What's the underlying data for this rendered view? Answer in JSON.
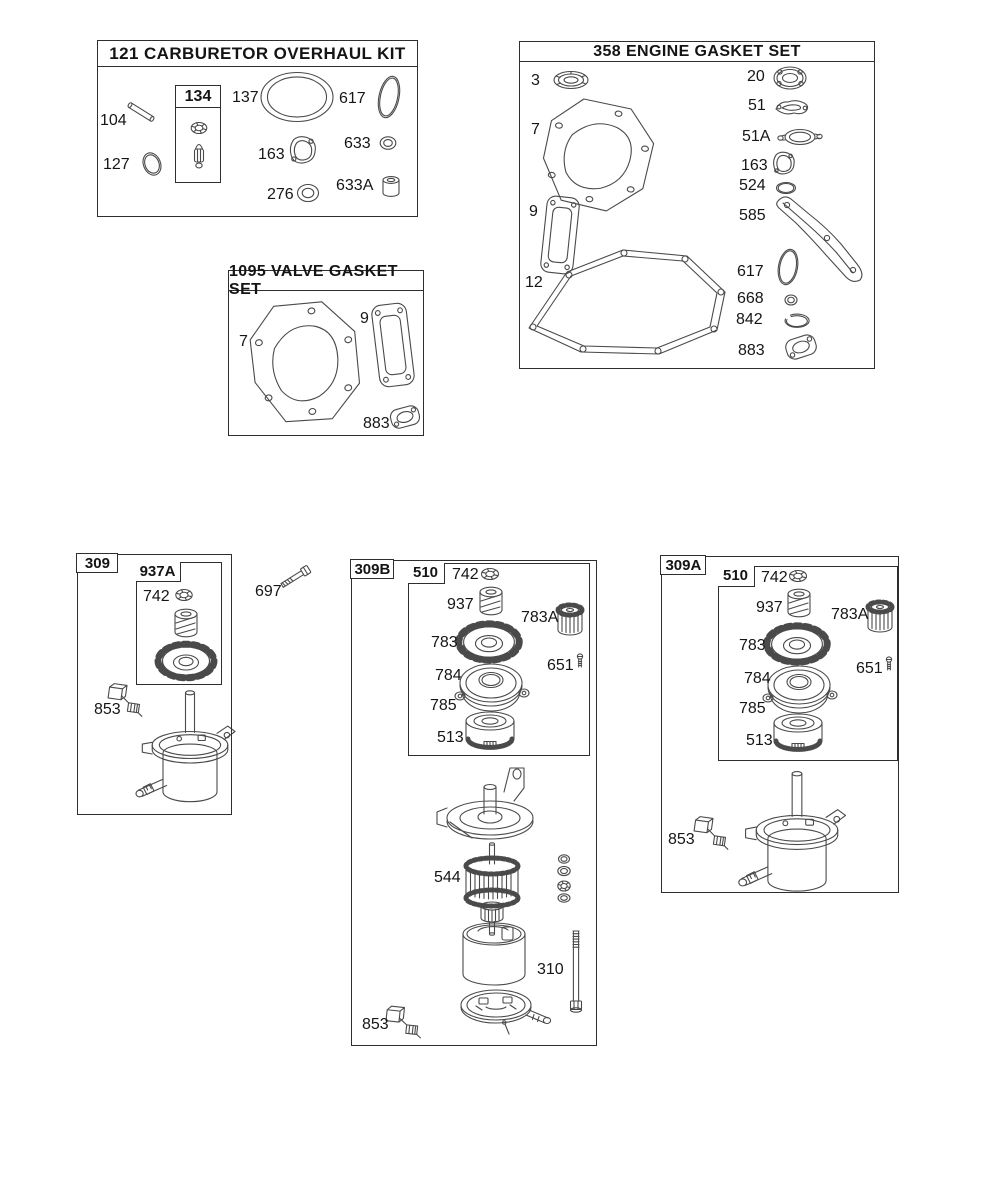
{
  "canvas": {
    "width": 1005,
    "height": 1200,
    "background": "#ffffff",
    "line_color": "#4a4a4a"
  },
  "sections": {
    "carburetor_kit": {
      "title": "121 CARBURETOR OVERHAUL KIT",
      "inner_box_label": "134",
      "parts": {
        "104": "104",
        "127": "127",
        "137": "137",
        "617": "617",
        "163": "163",
        "633": "633",
        "276": "276",
        "633A": "633A"
      }
    },
    "engine_gasket_set": {
      "title": "358 ENGINE GASKET SET",
      "parts": {
        "3": "3",
        "7": "7",
        "9": "9",
        "12": "12",
        "20": "20",
        "51": "51",
        "51A": "51A",
        "163": "163",
        "524": "524",
        "585": "585",
        "617": "617",
        "668": "668",
        "842": "842",
        "883": "883"
      }
    },
    "valve_gasket_set": {
      "title": "1095 VALVE GASKET SET",
      "parts": {
        "7": "7",
        "9": "9",
        "883": "883"
      }
    },
    "starter_309": {
      "code": "309",
      "inner_box_label": "937A",
      "parts": {
        "742": "742",
        "853": "853"
      },
      "loose_parts": {
        "697": "697"
      }
    },
    "starter_309b": {
      "code": "309B",
      "inner_box_label": "510",
      "parts": {
        "742": "742",
        "937": "937",
        "783A": "783A",
        "783": "783",
        "651": "651",
        "784": "784",
        "785": "785",
        "513": "513",
        "544": "544",
        "310": "310",
        "853": "853"
      }
    },
    "starter_309a": {
      "code": "309A",
      "inner_box_label": "510",
      "parts": {
        "742": "742",
        "937": "937",
        "783A": "783A",
        "783": "783",
        "651": "651",
        "784": "784",
        "785": "785",
        "513": "513",
        "853": "853"
      }
    }
  }
}
